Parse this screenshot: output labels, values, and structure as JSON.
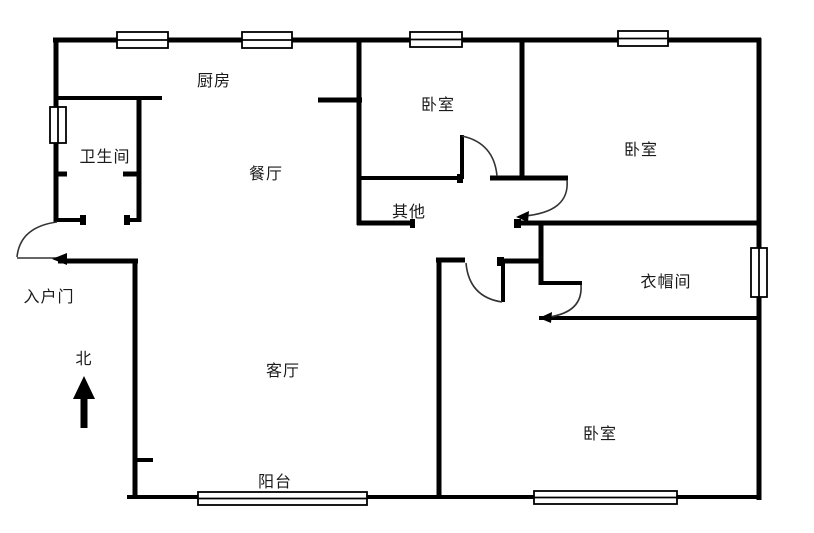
{
  "title": "apartment floor plan",
  "compass": {
    "label": "北"
  },
  "entrance": {
    "label": "入户门"
  },
  "rooms": {
    "kitchen": "厨房",
    "bathroom": "卫生间",
    "dining": "餐厅",
    "bedroom_top_middle": "卧室",
    "bedroom_top_right": "卧室",
    "other": "其他",
    "cloakroom": "衣帽间",
    "living": "客厅",
    "bedroom_bottom": "卧室",
    "balcony": "阳台"
  },
  "colors": {
    "wall": "#000000",
    "background": "#ffffff",
    "text": "#1a1a1a",
    "door_arc": "#333333"
  }
}
